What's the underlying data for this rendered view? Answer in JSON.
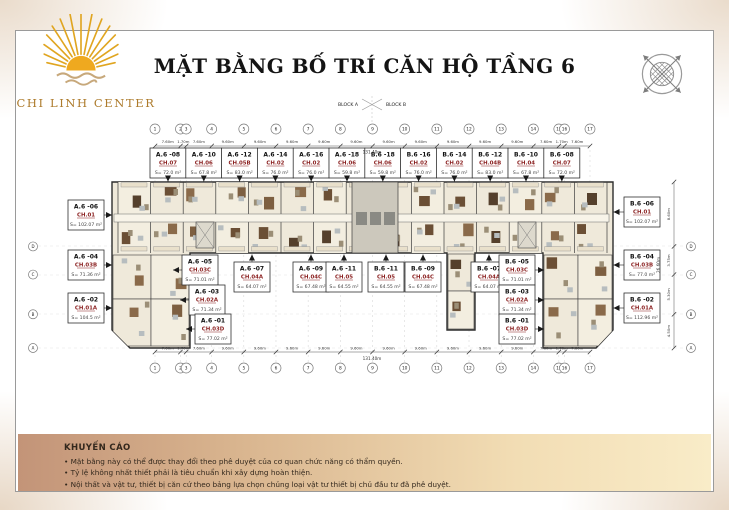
{
  "header": {
    "brand": "CHI LINH CENTER",
    "title": "MẶT BẰNG BỐ TRÍ CĂN HỘ TẦNG 6"
  },
  "blocks": {
    "left": "BLOCK A",
    "right": "BLOCK B"
  },
  "grid": {
    "axes": [
      "1",
      "2",
      "3",
      "4",
      "5",
      "6",
      "7",
      "8",
      "9",
      "10",
      "11",
      "12",
      "13",
      "14",
      "15",
      "16",
      "17"
    ],
    "dims": [
      "7.60m",
      "1.70m",
      "7.60m",
      "9.60m",
      "9.60m",
      "9.60m",
      "9.60m",
      "9.60m",
      "9.60m",
      "9.60m",
      "9.60m",
      "9.60m",
      "9.60m",
      "7.60m",
      "1.70m",
      "7.60m"
    ],
    "total": "131.40m",
    "side_axes": [
      "D",
      "C",
      "B",
      "A"
    ],
    "side_dims": [
      "8.60m",
      "3.75m",
      "5.30m",
      "4.50m"
    ],
    "side_total": "26.60m"
  },
  "apartments": {
    "top_row": [
      {
        "id": "A.6 -08",
        "unit": "CH.07",
        "area": "S= 72.0 m²"
      },
      {
        "id": "A.6 -10",
        "unit": "CH.06",
        "area": "S= 67.8 m²"
      },
      {
        "id": "A.6 -12",
        "unit": "CH.05B",
        "area": "S= 83.0 m²"
      },
      {
        "id": "A.6 -14",
        "unit": "CH.02",
        "area": "S= 76.0 m²"
      },
      {
        "id": "A.6 -16",
        "unit": "CH.02",
        "area": "S= 76.0 m²"
      },
      {
        "id": "A.6 -18",
        "unit": "CH.06",
        "area": "S= 59.8 m²"
      },
      {
        "id": "B.6 -18",
        "unit": "CH.06",
        "area": "S= 59.8 m²"
      },
      {
        "id": "B.6 -16",
        "unit": "CH.02",
        "area": "S= 76.0 m²"
      },
      {
        "id": "B.6 -14",
        "unit": "CH.02",
        "area": "S= 76.0 m²"
      },
      {
        "id": "B.6 -12",
        "unit": "CH.04B",
        "area": "S= 83.0 m²"
      },
      {
        "id": "B.6 -10",
        "unit": "CH.04",
        "area": "S= 67.8 m²"
      },
      {
        "id": "B.6 -08",
        "unit": "CH.07",
        "area": "S= 72.0 m²"
      }
    ],
    "left_col": [
      {
        "id": "A.6 -06",
        "unit": "CH.01",
        "area": "S= 102.07 m²"
      },
      {
        "id": "A.6 -04",
        "unit": "CH.03B",
        "area": "S= 71.36 m²"
      },
      {
        "id": "A.6 -02",
        "unit": "CH.01A",
        "area": "S= 104.5 m²"
      }
    ],
    "inner_left": [
      {
        "id": "A.6 -05",
        "unit": "CH.03C",
        "area": "S= 71.01 m²"
      },
      {
        "id": "A.6 -03",
        "unit": "CH.02A",
        "area": "S= 71.34 m²"
      },
      {
        "id": "A.6 -01",
        "unit": "CH.03D",
        "area": "S= 77.02 m²"
      }
    ],
    "bottom_row": [
      {
        "id": "A.6 -07",
        "unit": "CH.04A",
        "area": "S= 64.07 m²"
      },
      {
        "id": "A.6 -09",
        "unit": "CH.04C",
        "area": "S= 67.48 m²"
      },
      {
        "id": "A.6 -11",
        "unit": "CH.05",
        "area": "S= 64.55 m²"
      },
      {
        "id": "B.6 -11",
        "unit": "CH.05",
        "area": "S= 64.55 m²"
      },
      {
        "id": "B.6 -09",
        "unit": "CH.04C",
        "area": "S= 67.48 m²"
      },
      {
        "id": "B.6 -07",
        "unit": "CH.04A",
        "area": "S= 64.07 m²"
      }
    ],
    "inner_right": [
      {
        "id": "B.6 -05",
        "unit": "CH.03C",
        "area": "S= 71.01 m²"
      },
      {
        "id": "B.6 -03",
        "unit": "CH.02A",
        "area": "S= 71.34 m²"
      },
      {
        "id": "B.6 -01",
        "unit": "CH.03D",
        "area": "S= 77.02 m²"
      }
    ],
    "right_col": [
      {
        "id": "B.6 -06",
        "unit": "CH.01",
        "area": "S= 102.07 m²"
      },
      {
        "id": "B.6 -04",
        "unit": "CH.03B",
        "area": "S= 77.0 m²"
      },
      {
        "id": "B.6 -02",
        "unit": "CH.01A",
        "area": "S= 112.96 m²"
      }
    ]
  },
  "disclaimer": {
    "heading": "KHUYẾN CÁO",
    "bullets": [
      "Mặt bằng này có thể được thay đổi theo phê duyệt của cơ quan chức năng có thẩm quyền.",
      "Tỷ lệ không nhất thiết phải là tiêu chuẩn khi xây dựng hoàn thiện.",
      "Nội thất và vật tư, thiết bị  căn cứ theo bảng lựa chọn chủng loại vật tư thiết bị chủ đầu tư đã phê duyệt."
    ]
  },
  "colors": {
    "brand_gold": "#e0a520",
    "brand_text": "#ad7b2c",
    "unit_label": "#8b2121",
    "band_left": "#c39478",
    "band_right": "#f9ecc8",
    "plan_floor": "#efe9da",
    "plan_wall": "#2d2d2d"
  }
}
